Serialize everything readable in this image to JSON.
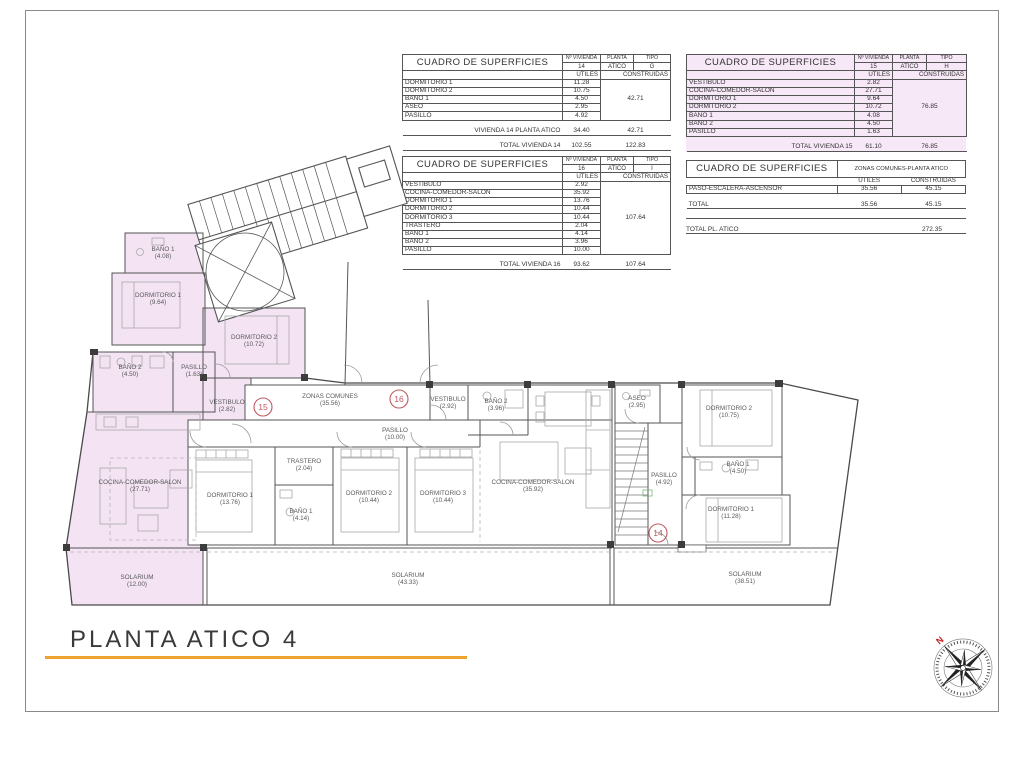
{
  "title": "PLANTA ATICO 4",
  "colors": {
    "highlight_pink": "#f3e3f3",
    "accent_orange": "#efa32f",
    "marker_red": "#bf5860"
  },
  "tables": {
    "v14": {
      "title": "CUADRO DE SUPERFICIES",
      "col_vivienda_label": "Nº VIVIENDA",
      "col_planta_label": "PLANTA",
      "col_tipo_label": "TIPO",
      "vivienda": "14",
      "planta": "ATICO",
      "tipo": "G",
      "utiles_label": "UTILES",
      "construidas_label": "CONSTRUIDAS",
      "rows": [
        {
          "concept": "DORMITORIO 1",
          "utiles": "11.28"
        },
        {
          "concept": "DORMITORIO 2",
          "utiles": "10.75"
        },
        {
          "concept": "BAÑO 1",
          "utiles": "4.50"
        },
        {
          "concept": "ASEO",
          "utiles": "2.95"
        },
        {
          "concept": "PASILLO",
          "utiles": "4.92"
        }
      ],
      "construidas_total": "42.71",
      "subtotal": {
        "label": "VIVIENDA 14 PLANTA ATICO",
        "utiles": "34.40",
        "construidas": "42.71"
      },
      "total": {
        "label": "TOTAL VIVIENDA 14",
        "utiles": "102.55",
        "construidas": "122.83"
      }
    },
    "v15": {
      "title": "CUADRO DE SUPERFICIES",
      "col_vivienda_label": "Nº VIVIENDA",
      "col_planta_label": "PLANTA",
      "col_tipo_label": "TIPO",
      "vivienda": "15",
      "planta": "ATICO",
      "tipo": "H",
      "utiles_label": "UTILES",
      "construidas_label": "CONSTRUIDAS",
      "rows": [
        {
          "concept": "VESTIBULO",
          "utiles": "2.82"
        },
        {
          "concept": "COCINA-COMEDOR-SALON",
          "utiles": "27.71"
        },
        {
          "concept": "DORMITORIO 1",
          "utiles": "9.64"
        },
        {
          "concept": "DORMITORIO 2",
          "utiles": "10.72"
        },
        {
          "concept": "BAÑO 1",
          "utiles": "4.08"
        },
        {
          "concept": "BAÑO 2",
          "utiles": "4.50"
        },
        {
          "concept": "PASILLO",
          "utiles": "1.63"
        }
      ],
      "construidas_total": "76.85",
      "total": {
        "label": "TOTAL VIVIENDA 15",
        "utiles": "61.10",
        "construidas": "76.85"
      }
    },
    "v16": {
      "title": "CUADRO DE SUPERFICIES",
      "col_vivienda_label": "Nº VIVIENDA",
      "col_planta_label": "PLANTA",
      "col_tipo_label": "TIPO",
      "vivienda": "16",
      "planta": "ATICO",
      "tipo": "I",
      "utiles_label": "UTILES",
      "construidas_label": "CONSTRUIDAS",
      "rows": [
        {
          "concept": "VESTIBULO",
          "utiles": "2.92"
        },
        {
          "concept": "COCINA-COMEDOR-SALON",
          "utiles": "35.92"
        },
        {
          "concept": "DORMITORIO 1",
          "utiles": "13.76"
        },
        {
          "concept": "DORMITORIO 2",
          "utiles": "10.44"
        },
        {
          "concept": "DORMITORIO 3",
          "utiles": "10.44"
        },
        {
          "concept": "TRASTERO",
          "utiles": "2.04"
        },
        {
          "concept": "BAÑO 1",
          "utiles": "4.14"
        },
        {
          "concept": "BAÑO 2",
          "utiles": "3.96"
        },
        {
          "concept": "PASILLO",
          "utiles": "10.00"
        }
      ],
      "construidas_total": "107.64",
      "total": {
        "label": "TOTAL VIVIENDA 16",
        "utiles": "93.62",
        "construidas": "107.64"
      }
    },
    "comunes": {
      "title": "CUADRO DE SUPERFICIES",
      "header": "ZONAS COMUNES-PLANTA ATICO",
      "utiles_label": "UTILES",
      "construidas_label": "CONSTRUIDAS",
      "rows": [
        {
          "concept": "PASO-ESCALERA-ASCENSOR",
          "utiles": "35.56",
          "construidas": "45.15"
        }
      ],
      "total": {
        "label": "TOTAL",
        "utiles": "35.56",
        "construidas": "45.15"
      },
      "grand_total": {
        "label": "TOTAL PL. ATICO",
        "construidas": "272.35"
      }
    }
  },
  "plan": {
    "rooms": [
      {
        "name": "BAÑO 1",
        "area": "(4.08)"
      },
      {
        "name": "DORMITORIO 1",
        "area": "(9.64)"
      },
      {
        "name": "DORMITORIO 2",
        "area": "(10.72)"
      },
      {
        "name": "BAÑO 2",
        "area": "(4.50)"
      },
      {
        "name": "PASILLO",
        "area": "(1.63)"
      },
      {
        "name": "VESTIBULO",
        "area": "(2.82)"
      },
      {
        "name": "COCINA-COMEDOR-SALON",
        "area": "(27.71)"
      },
      {
        "name": "SOLARIUM",
        "area": "(12.00)"
      },
      {
        "name": "ZONAS COMUNES",
        "area": "(35.56)"
      },
      {
        "name": "VESTIBULO",
        "area": "(2.92)"
      },
      {
        "name": "BAÑO 2",
        "area": "(3.96)"
      },
      {
        "name": "PASILLO",
        "area": "(10.00)"
      },
      {
        "name": "TRASTERO",
        "area": "(2.04)"
      },
      {
        "name": "DORMITORIO 1",
        "area": "(13.76)"
      },
      {
        "name": "BAÑO 1",
        "area": "(4.14)"
      },
      {
        "name": "DORMITORIO 2",
        "area": "(10.44)"
      },
      {
        "name": "DORMITORIO 3",
        "area": "(10.44)"
      },
      {
        "name": "COCINA-COMEDOR-SALON",
        "area": "(35.92)"
      },
      {
        "name": "SOLARIUM",
        "area": "(43.33)"
      },
      {
        "name": "ASEO",
        "area": "(2.95)"
      },
      {
        "name": "PASILLO",
        "area": "(4.92)"
      },
      {
        "name": "DORMITORIO 2",
        "area": "(10.75)"
      },
      {
        "name": "BAÑO 1",
        "area": "(4.50)"
      },
      {
        "name": "DORMITORIO 1",
        "area": "(11.28)"
      },
      {
        "name": "SOLARIUM",
        "area": "(38.51)"
      }
    ],
    "markers": [
      {
        "number": "15"
      },
      {
        "number": "16"
      },
      {
        "number": "14"
      }
    ]
  },
  "compass": {
    "north_label": "N"
  }
}
